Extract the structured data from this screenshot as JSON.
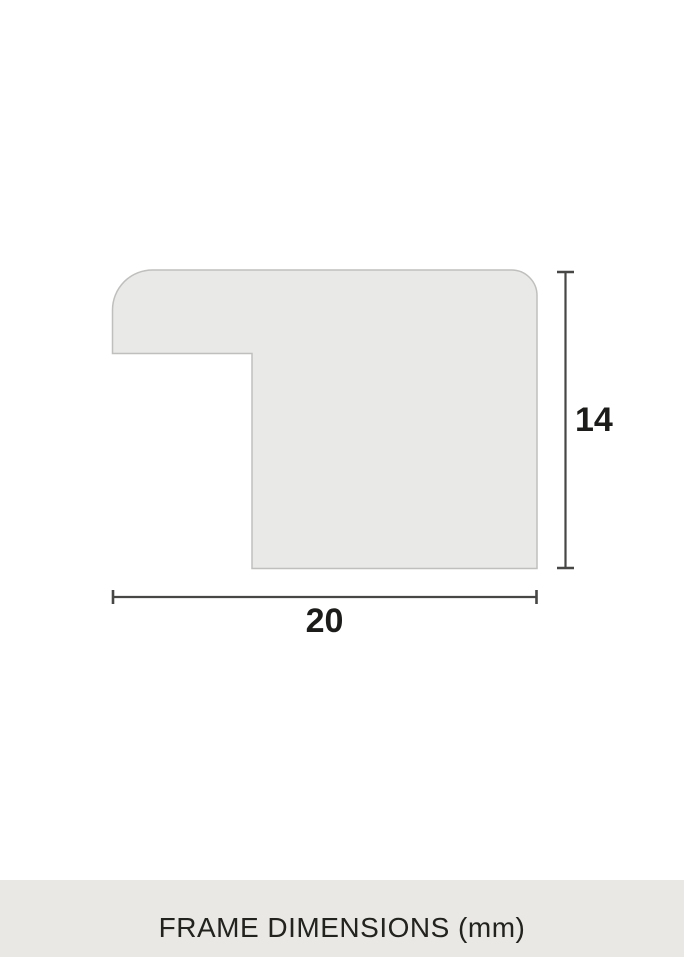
{
  "colors": {
    "page_bg": "#ffffff",
    "shape_fill": "#e9e9e7",
    "shape_stroke": "#bfbfbd",
    "dimension_line": "#474745",
    "label_text": "#1c1c1a",
    "footer_bg": "#eae8e5",
    "footer_text": "#22221f"
  },
  "diagram": {
    "description": "frame-moulding-profile-cross-section",
    "height_label": "14",
    "width_label": "20"
  },
  "footer": {
    "label": "FRAME DIMENSIONS (mm)"
  }
}
